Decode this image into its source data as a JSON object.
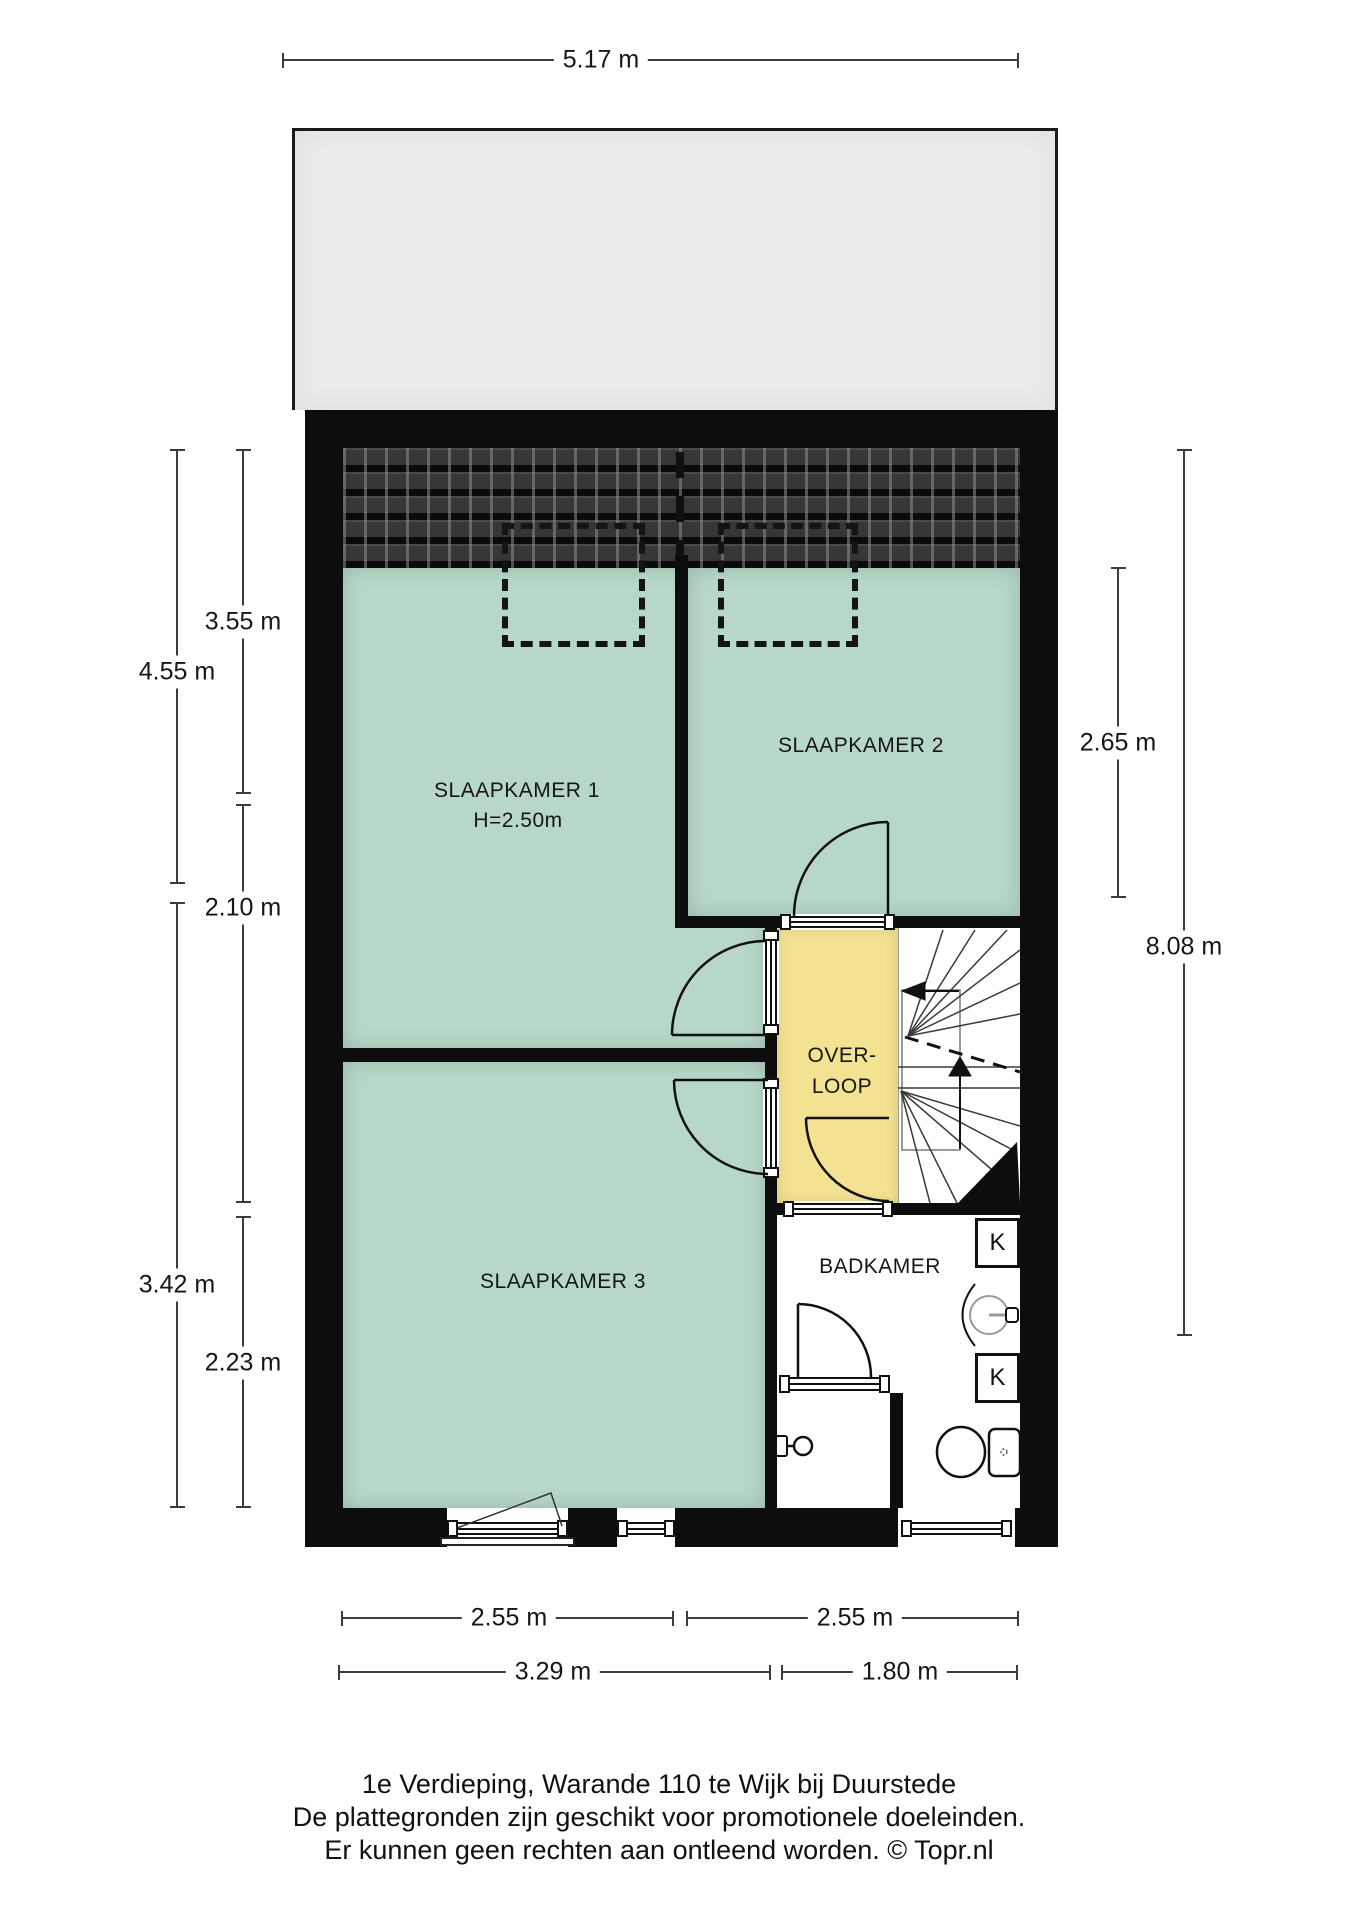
{
  "rooms": {
    "slaapkamer1": {
      "label": "SLAAPKAMER 1",
      "height_note": "H=2.50m"
    },
    "slaapkamer2": {
      "label": "SLAAPKAMER 2"
    },
    "slaapkamer3": {
      "label": "SLAAPKAMER 3"
    },
    "overloop": {
      "line1": "OVER-",
      "line2": "LOOP"
    },
    "badkamer": {
      "label": "BADKAMER"
    },
    "closet_top": {
      "label": "K"
    },
    "closet_bottom": {
      "label": "K"
    }
  },
  "dimensions": {
    "top": "5.17 m",
    "left_outer_upper": "4.55 m",
    "left_outer_lower": "3.42 m",
    "left_inner_upper": "3.55 m",
    "left_inner_middle": "2.10 m",
    "left_inner_lower": "2.23 m",
    "right_inner": "2.65 m",
    "right_outer": "8.08 m",
    "bottom_row1_left": "2.55 m",
    "bottom_row1_right": "2.55 m",
    "bottom_row2_left": "3.29 m",
    "bottom_row2_right": "1.80 m"
  },
  "footer": {
    "line1": "1e Verdieping, Warande 110 te Wijk bij Duurstede",
    "line2": "De plattegronden zijn geschikt voor promotionele doeleinden.",
    "line3": "Er kunnen geen rechten aan ontleend worden. © Topr.nl"
  },
  "colors": {
    "room_green": "#b7d8c8",
    "overloop_yellow": "#f2e291",
    "wall_black": "#0d0d0d",
    "roof_gray": "#ebebeb"
  }
}
